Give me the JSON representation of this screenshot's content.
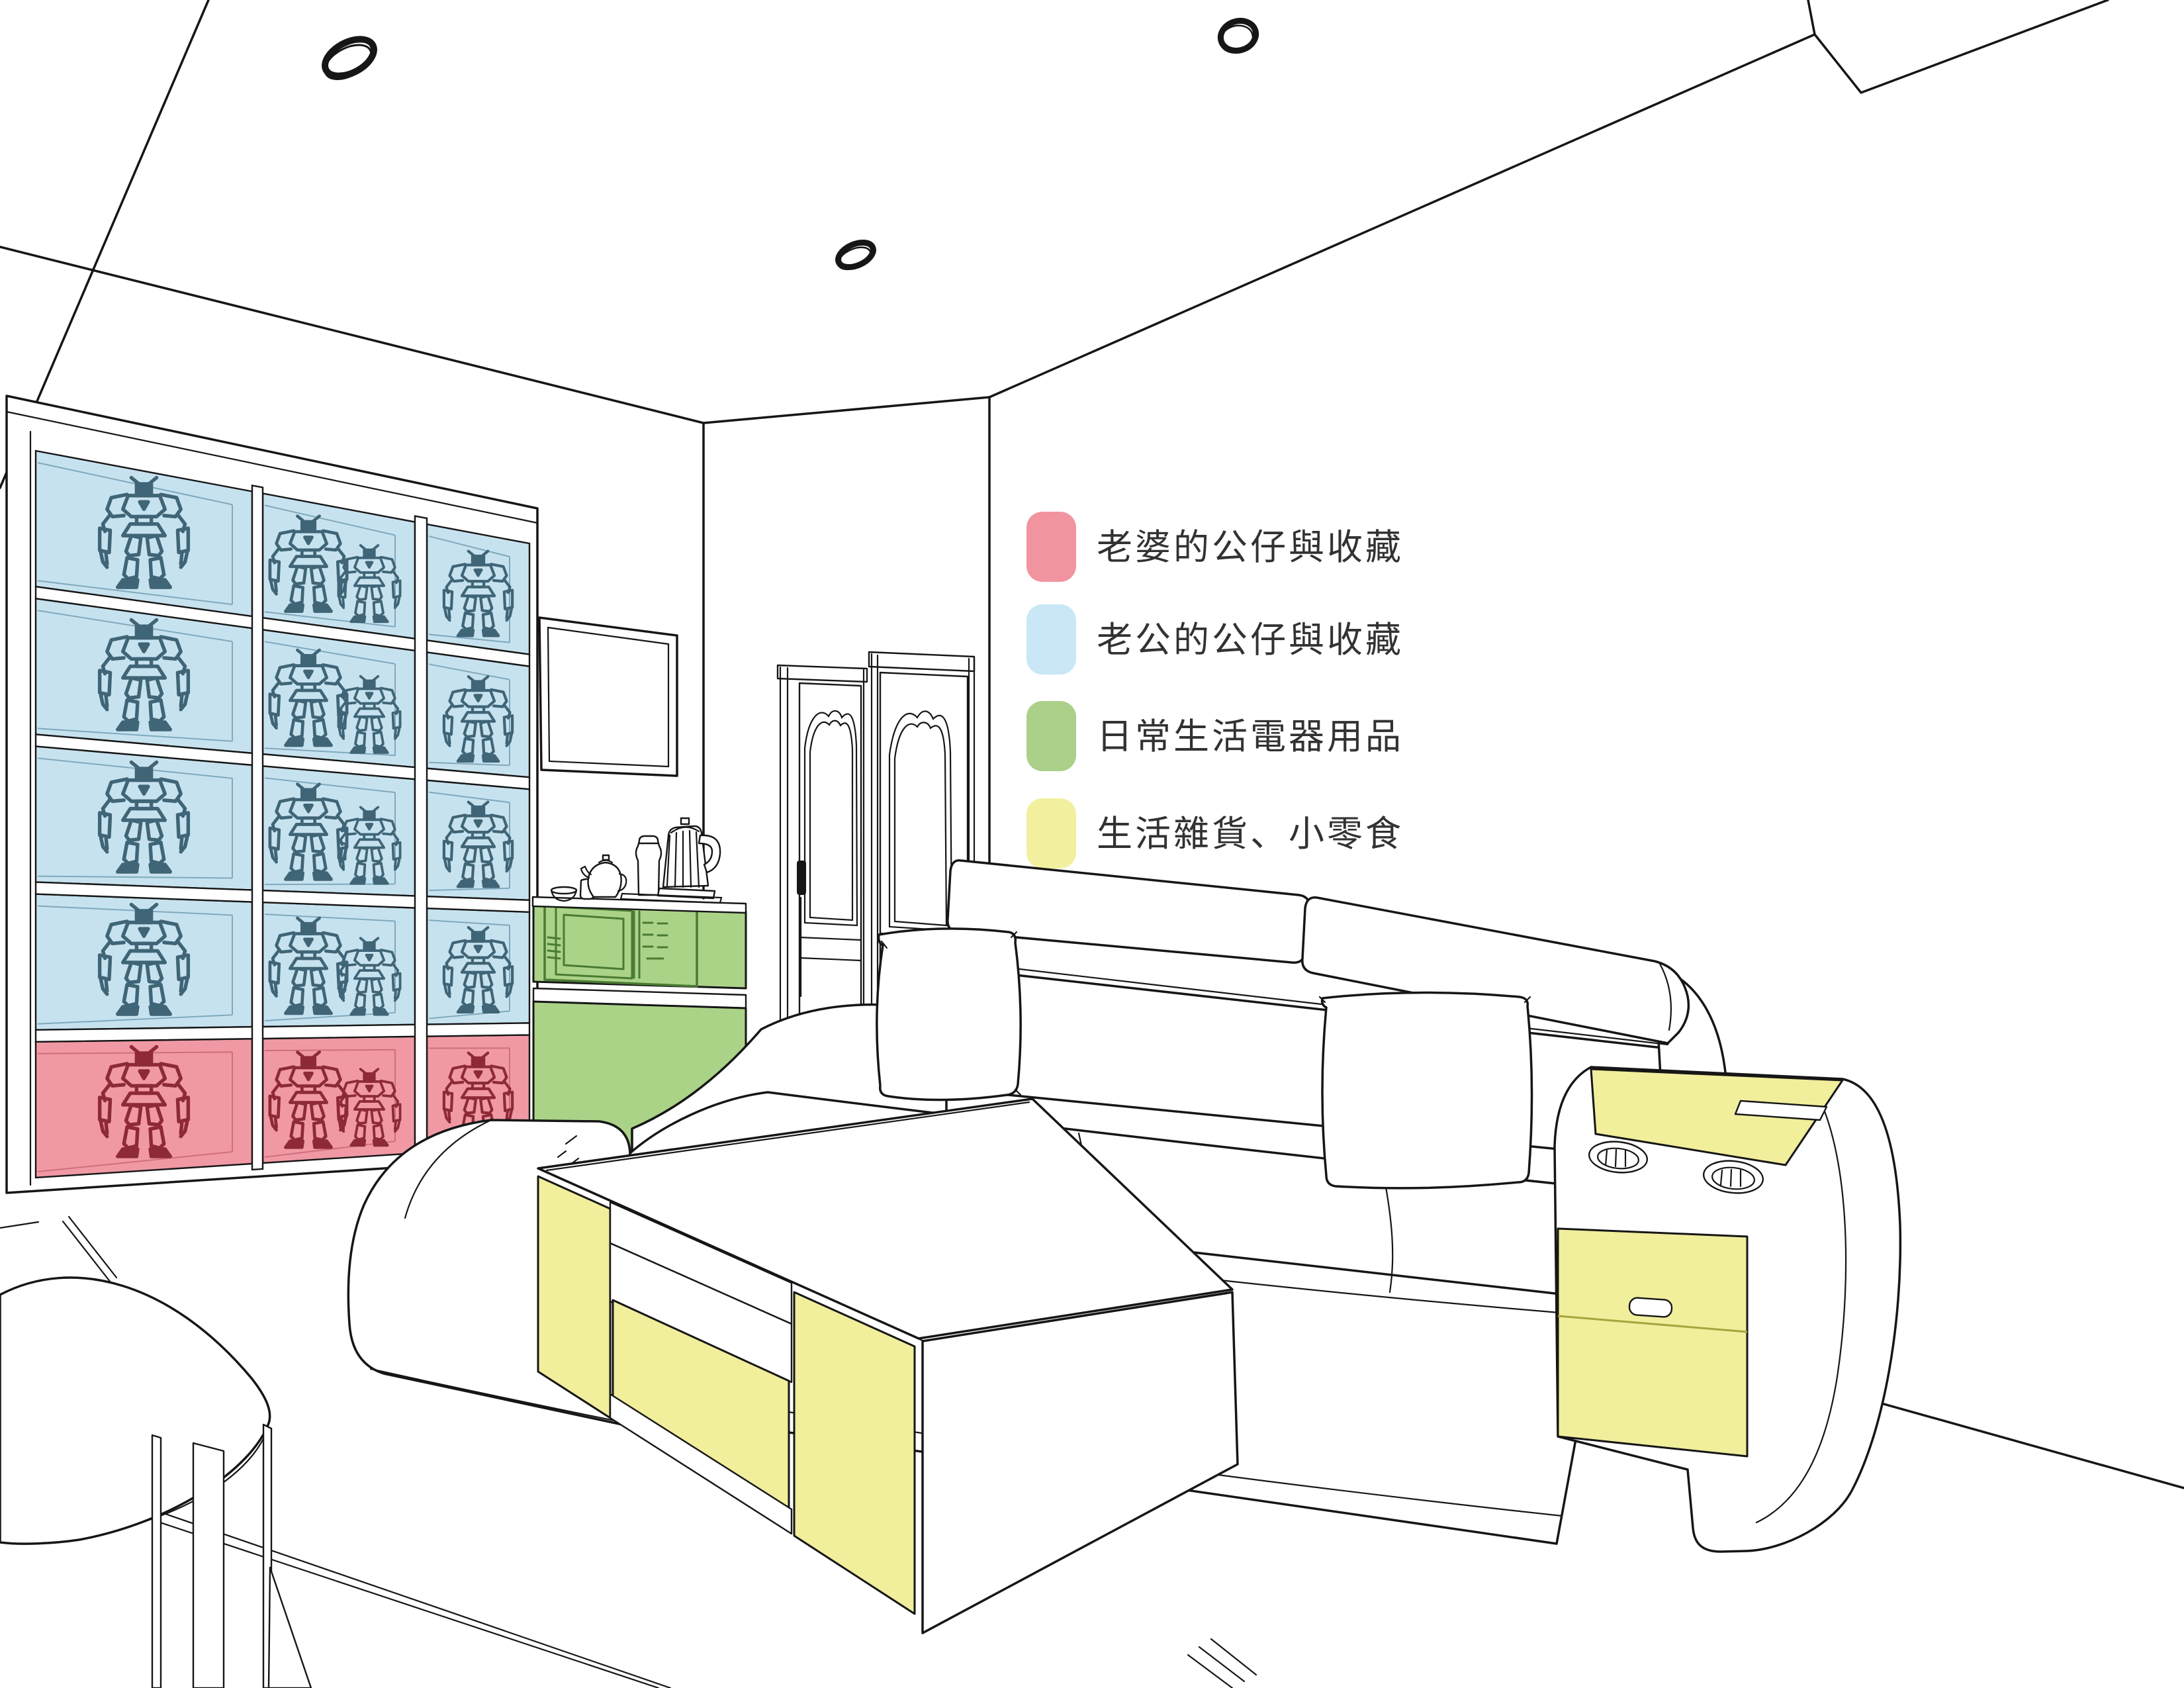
{
  "colors": {
    "line": "#161616",
    "wall": "#ffffff",
    "text": "#323232",
    "cell_blue": "#c7e2ef",
    "cell_pink": "#f099a4",
    "blue_depth": "#7fa9bd",
    "pink_depth": "#cf6e7d",
    "robot_blue": "#3f6577",
    "robot_pink": "#8e2a38",
    "green_fill": "#abd388",
    "green_line": "#4a7a33",
    "yellow_fill": "#f1ee9c",
    "yellow_line": "#a8a43e"
  },
  "legend": {
    "items": [
      {
        "label": "老婆的公仔與收藏",
        "color": "#f2949f"
      },
      {
        "label": "老公的公仔與收藏",
        "color": "#c9e7f6"
      },
      {
        "label": "日常生活電器用品",
        "color": "#abd089"
      },
      {
        "label": "生活雜貨、小零食",
        "color": "#f2f09e"
      }
    ]
  },
  "shelf": {
    "rows": 5,
    "columns": 3,
    "pink_row_index": 4,
    "figures_per_column": [
      1,
      2,
      1
    ]
  },
  "scene": {
    "ceiling_light_count": 3,
    "door_count": 2,
    "cup_holder_count": 2,
    "sofa_pillow_count": 2,
    "sofa_headrest_count": 2
  }
}
